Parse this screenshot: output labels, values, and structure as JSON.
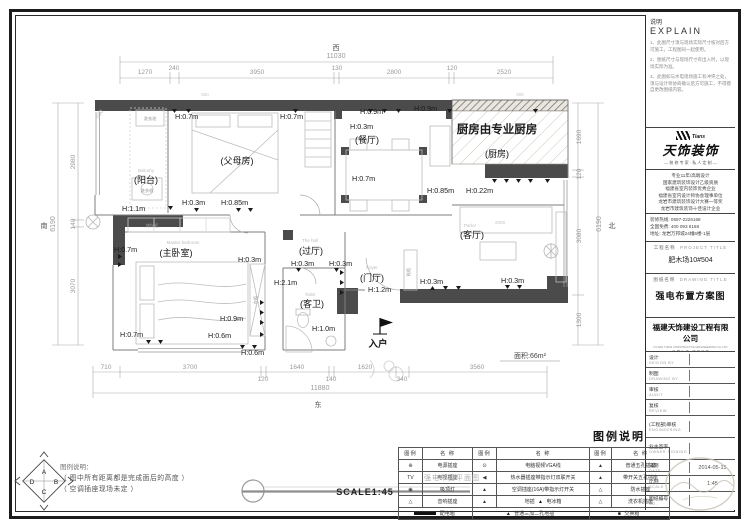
{
  "sheet": {
    "explain": {
      "title_cn": "说明",
      "title_en": "EXPLAIN",
      "notes": [
        "1、此图尺寸须与现场实际尺寸核对后方可施工，工程图同一起使用。",
        "2、图纸尺寸与现场尺寸有出入时，以现场实际为准。",
        "3、此图如与水电现场施工有冲突之处，须与设计师协商确认后方可施工，不得擅自更改图纸内容。"
      ]
    },
    "logo": {
      "brand": "天饰装饰",
      "brand_en": "Tians",
      "tagline": "— 装 修 专 家 · 私 人 定 制 —"
    },
    "credentials": [
      "专业11年/高端设计",
      "国家建筑装饰设计乙级资质",
      "福建省室内装饰优秀企业",
      "福建省室内设计师协会理事单位",
      "龙岩市建筑装饰设计大赛一等奖",
      "龙岩市建筑装饰十佳设计企业"
    ],
    "contact": [
      "装修热线: 0597-2226168",
      "全国免费: 400 093 6168",
      "地址: 龙岩万邦城24幢6楼-1层"
    ],
    "project": {
      "label_cn": "工程名称",
      "label_en": "PROJECT TITLE",
      "value": "肥木场10#504"
    },
    "drawing": {
      "label_cn": "图纸名称",
      "label_en": "DRAWING TITLE",
      "value": "强电布置方案图"
    },
    "company": {
      "name": "福建天饰建设工程有限公司",
      "name_en": "FUJIAN TIANS CONSTRUCTION ENGINEERING CO.,LTD",
      "tagline": "— 品 质 为 本 · 诚 信 经 营 —"
    },
    "fields": [
      {
        "cn": "设计",
        "en": "DESIGN BY",
        "value": ""
      },
      {
        "cn": "制图",
        "en": "DRAWING BY",
        "value": ""
      },
      {
        "cn": "审核",
        "en": "AUDIT",
        "value": ""
      },
      {
        "cn": "复核",
        "en": "REVIEW",
        "value": ""
      },
      {
        "cn": "(工程部)审核",
        "en": "ENGINEERING",
        "value": ""
      },
      {
        "cn": "业主签字",
        "en": "OWNER SIGNING",
        "value": ""
      },
      {
        "cn": "日期",
        "en": "DATE",
        "value": "2014-05-15"
      },
      {
        "cn": "比例",
        "en": "SCALE",
        "value": "1:45"
      },
      {
        "cn": "图纸编号",
        "en": "NO.",
        "value": ""
      }
    ]
  },
  "legend": {
    "title": "图例说明",
    "headers": [
      "图例",
      "名 称",
      "图例",
      "名 称",
      "图例",
      "名 称"
    ],
    "rows": [
      {
        "c1i": "⊕",
        "c1": "电源插座",
        "c2i": "⊙",
        "c2": "电脑视频VGA线",
        "c3i": "▲",
        "c3": "普通五孔插座"
      },
      {
        "c1i": "TV",
        "c1": "电视插座",
        "c2i": "◀",
        "c2": "热水器插座带指示灯双联开关",
        "c3i": "▲",
        "c3": "带开关五孔插座"
      },
      {
        "c1i": "◉",
        "c1": "吸顶灯",
        "c2i": "▲",
        "c2": "空调插座(16A)带指示灯开关",
        "c3i": "△",
        "c3": "防水插座"
      },
      {
        "c1i": "△",
        "c1": "音响插座",
        "c2i": "▲",
        "c2": "地插",
        "c2bi": "▲",
        "c2b": "电冰箱",
        "c3i": "△",
        "c3": "洗衣机插座"
      }
    ],
    "footer": {
      "f1": "配电箱",
      "f2i": "▲",
      "f2": "普通三加二孔地插",
      "f3i": "■",
      "f3": "交换箱"
    }
  },
  "footnote": {
    "title": "图例说明：",
    "lines": [
      "（ 图中所有距离都是完成面后的高度 ）",
      "（ 空调插座现场未定 ）"
    ],
    "compass": {
      "a": "A",
      "b": "B",
      "c": "C",
      "d": "D"
    }
  },
  "scalebar": {
    "title": "强电布置平面图",
    "scale": "SCALE1:45"
  },
  "plan": {
    "compass": {
      "top": "西",
      "right": "北",
      "bottom": "东",
      "left": "南"
    },
    "kitchen_note": "厨房由专业厨房",
    "area": "面积:66m²",
    "entry": "入户",
    "rooms": [
      {
        "cn": "(阳台)",
        "en": "Balcony"
      },
      {
        "cn": "(父母房)",
        "en": ""
      },
      {
        "cn": "(餐厅)",
        "en": ""
      },
      {
        "cn": "(厨房)",
        "en": ""
      },
      {
        "cn": "(客厅)",
        "en": "Parlor"
      },
      {
        "cn": "(主卧室)",
        "en": "Master bedroom"
      },
      {
        "cn": "(过厅)",
        "en": "The hall"
      },
      {
        "cn": "(客卫)",
        "en": "Toilet"
      },
      {
        "cn": "(门厅)",
        "en": "Foyer"
      }
    ],
    "fixtures": [
      "洗衣池",
      "洗衣机",
      "储存柜",
      "衣柜",
      "鞋柜"
    ],
    "heights": [
      "H:0.7m",
      "H:0.7m",
      "H:0.9m",
      "H:0.9m",
      "H:0.3m",
      "H:0.7m",
      "H:0.3m",
      "H:0.85m",
      "H:1.1m",
      "H:0.85m",
      "H:0.22m",
      "H:0.3m",
      "H:0.3m",
      "H:2.1m",
      "H:1.0m",
      "H:1.2m",
      "H:0.3m",
      "H:0.3m",
      "H:0.7m",
      "H:0.3m",
      "H:0.9m",
      "H:0.7m",
      "H:0.6m",
      "H:0.6m"
    ],
    "minor_dims": [
      "600",
      "600",
      "2000"
    ],
    "dims": {
      "top": [
        "1270",
        "240",
        "3950",
        "130",
        "2800",
        "120",
        "2520"
      ],
      "top_total": "11030",
      "bottom": [
        "710",
        "3700",
        "120",
        "1640",
        "140",
        "1620",
        "340",
        "3560"
      ],
      "bottom_total": "11880",
      "left": [
        "2980",
        "140",
        "3070"
      ],
      "left_total": "6190",
      "right": [
        "1690",
        "120",
        "3080",
        "1300"
      ],
      "right_total": "6190",
      "small": "500"
    }
  }
}
